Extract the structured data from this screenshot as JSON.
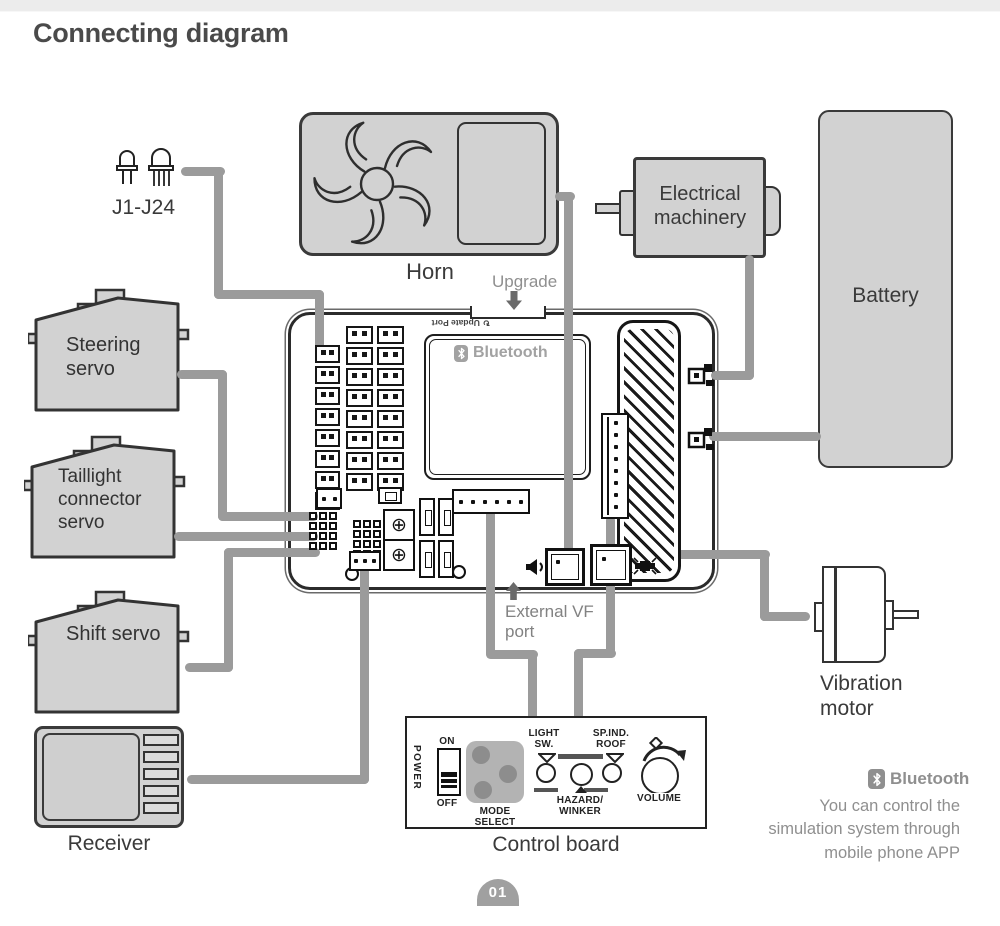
{
  "page": {
    "title": "Connecting diagram",
    "page_number": "01"
  },
  "labels": {
    "leds": "J1-J24",
    "horn": "Horn",
    "upgrade": "Upgrade",
    "electrical_machinery": "Electrical machinery",
    "battery": "Battery",
    "steering_servo": "Steering servo",
    "taillight_servo": "Taillight connector servo",
    "shift_servo": "Shift servo",
    "receiver": "Receiver",
    "vibration_motor": "Vibration motor",
    "external_vf_port": "External VF port",
    "control_board": "Control board"
  },
  "board": {
    "bluetooth_label": "Bluetooth",
    "update_port_label": "Update Port",
    "socket_columns": [
      8,
      8,
      8
    ]
  },
  "control_board_panel": {
    "power": "POWER",
    "on": "ON",
    "off": "OFF",
    "mode_select": "MODE SELECT",
    "light_sw": "LIGHT SW.",
    "hazard_winker": "HAZARD/ WINKER",
    "sp_ind_roof": "SP.IND. ROOF",
    "volume": "VOLUME"
  },
  "bluetooth_note": {
    "brand": "Bluetooth",
    "text": "You can control the simulation system through mobile phone APP"
  },
  "colors": {
    "box_fill": "#d2d2d2",
    "outline": "#333333",
    "wire": "#9b9b9b",
    "muted_text": "#8f8f8f",
    "dark_text": "#3a3a3a"
  }
}
